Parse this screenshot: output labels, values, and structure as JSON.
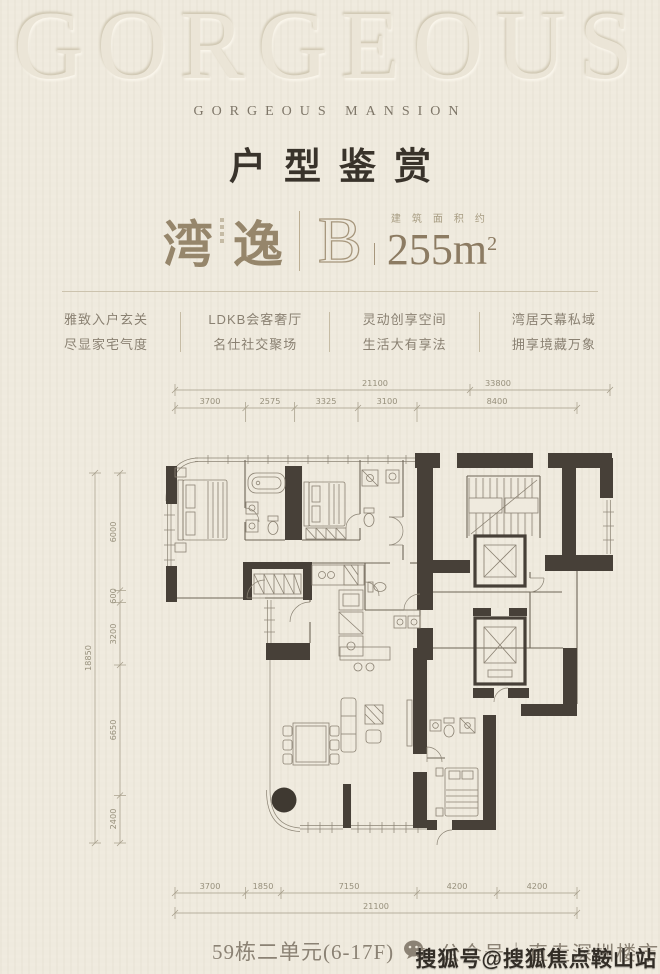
{
  "header": {
    "embossed_word": "GORGEOUS",
    "brand": "GORGEOUS MANSION",
    "title": "户型鉴赏"
  },
  "unit": {
    "name_chars": [
      "湾",
      "逸"
    ],
    "type_letter": "B",
    "area_prefix": "建筑面积约",
    "area_number": "255m",
    "area_exponent": "2"
  },
  "features": [
    {
      "line1": "雅致入户玄关",
      "line2": "尽显家宅气度"
    },
    {
      "line1": "LDKB会客奢厅",
      "line2": "名仕社交聚场"
    },
    {
      "line1": "灵动创享空间",
      "line2": "生活大有享法"
    },
    {
      "line1": "湾居天幕私域",
      "line2": "拥享境藏万象"
    }
  ],
  "floorplan": {
    "top_totals": [
      "21100",
      "33800"
    ],
    "top_segments": [
      "3700",
      "2575",
      "3325",
      "3100",
      "8400"
    ],
    "left_total": "18850",
    "left_segments": [
      "6000",
      "600",
      "3200",
      "6650",
      "2400"
    ],
    "bottom_segments": [
      "3700",
      "1850",
      "7150",
      "4200",
      "4200"
    ],
    "bottom_total": "21100"
  },
  "footer": {
    "building_info": "59栋二单元(6-17F)",
    "account_label": "公众号｜直走深圳楼市",
    "watermark": "搜狐号@搜狐焦点鞍山站"
  },
  "colors": {
    "background": "#efeade",
    "wall": "#474038",
    "accent_gold": "#96866b",
    "title_dark": "#39332b",
    "muted_text": "#8a8172"
  }
}
